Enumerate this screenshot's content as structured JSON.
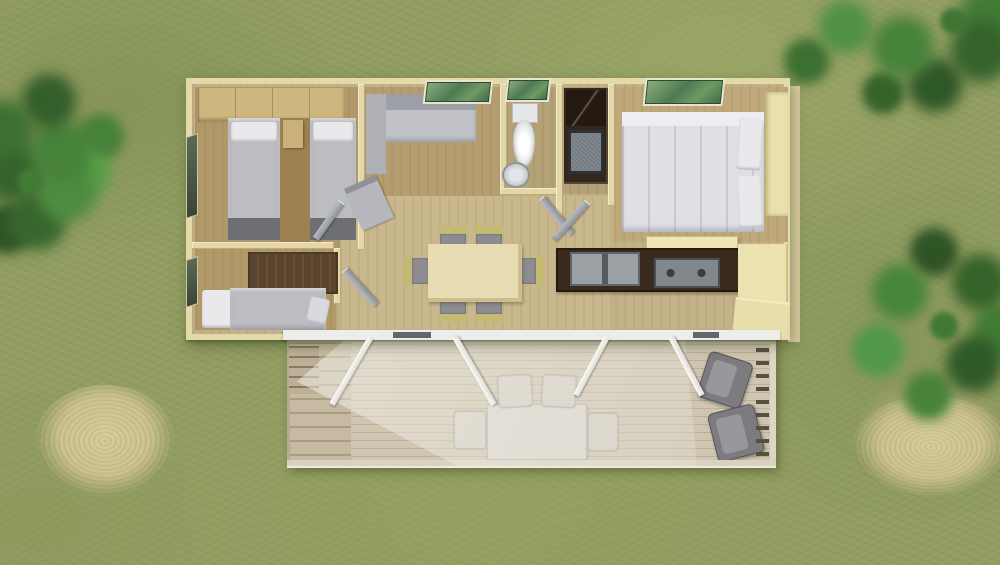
{
  "scene": {
    "type": "aerial-3d-floorplan-render",
    "subject": "Top-down 3D rendering of a rectangular mobile home with a front wooden deck, set on a grassy lot with trees and dry grass tufts",
    "no_visible_text": true,
    "palette": {
      "grass_base": "#919d61",
      "grass_light": "#a4ae6e",
      "grass_dark": "#7e8f53",
      "foliage_dark": "#2f5a28",
      "foliage_mid": "#417c36",
      "foliage_light": "#57a047",
      "dry_grass": "#d2c897",
      "sand_patch": "#c3b98d",
      "exterior_wall": "#e4d9ab",
      "interior_wall": "#e3d7a8",
      "floor_base": "#c3b287",
      "bedroom_floor": "#b09868",
      "deck_wood": "#cfc5b0",
      "awning_white": "#f3f2ee",
      "front_beam_white": "#edeeec",
      "kitchen_counter_dark": "#3a2a1d",
      "cabinet_cream": "#efe6b5",
      "wardrobe_tan": "#cdb77f",
      "mattress_gray": "#b9babe",
      "bedding_white": "#e2e3e7",
      "sofa_gray": "#c1c2c7",
      "door_gray": "#a2a6ad",
      "window_glass_green": "#5d8456",
      "toilet_white": "#f0f0f2",
      "armchair_gray": "#7b7b80"
    },
    "house": {
      "rooms": [
        {
          "name": "twin-bedroom",
          "position": "top-left",
          "contents": [
            "wardrobe strip",
            "two single beds with gray mattresses and white pillows",
            "nightstand",
            "side window"
          ]
        },
        {
          "name": "second-bedroom",
          "position": "bottom-left",
          "contents": [
            "single bed with white pillow",
            "dark wood cabinet",
            "side window",
            "open door"
          ]
        },
        {
          "name": "lounge",
          "position": "top-center-left",
          "contents": [
            "L-shaped gray sofa",
            "angled lounge chair",
            "green skylight"
          ]
        },
        {
          "name": "bathroom",
          "position": "top-center",
          "contents": [
            "white toilet",
            "corner washbasin",
            "green window",
            "open door"
          ]
        },
        {
          "name": "shower-room",
          "position": "top-center-right",
          "contents": [
            "dark shower-vanity unit with inset washbasin"
          ]
        },
        {
          "name": "master-bedroom",
          "position": "top-right",
          "contents": [
            "double bed with white duvet and side pillows",
            "full-height cream wardrobe",
            "green skylight",
            "low cream dresser",
            "open door"
          ]
        },
        {
          "name": "kitchen",
          "position": "center-right",
          "contents": [
            "dark worktop with double sink and cooktop",
            "cream cabinets along right wall"
          ]
        },
        {
          "name": "dining-area",
          "position": "center",
          "contents": [
            "rectangular light-wood table",
            "six chairs with gray seats and yellow-green frames"
          ]
        }
      ],
      "open_doors": 4,
      "skylights": 3,
      "side_windows": 2
    },
    "deck": {
      "position": "front-bottom",
      "features": [
        "wood plank terrace",
        "left access stairs",
        "four white awning support poles in V pairs",
        "translucent awning sheet",
        "outdoor table with four light chairs",
        "two gray lounge armchairs",
        "right-side railing with balusters",
        "white front beam with dark door tracks"
      ]
    },
    "landscape": {
      "vegetation": [
        "green tree on left edge",
        "green tree in top-right corner",
        "green bush on right side",
        "dry grass tuft bottom-left",
        "dry grass tuft bottom-right on sandy patch"
      ]
    }
  }
}
